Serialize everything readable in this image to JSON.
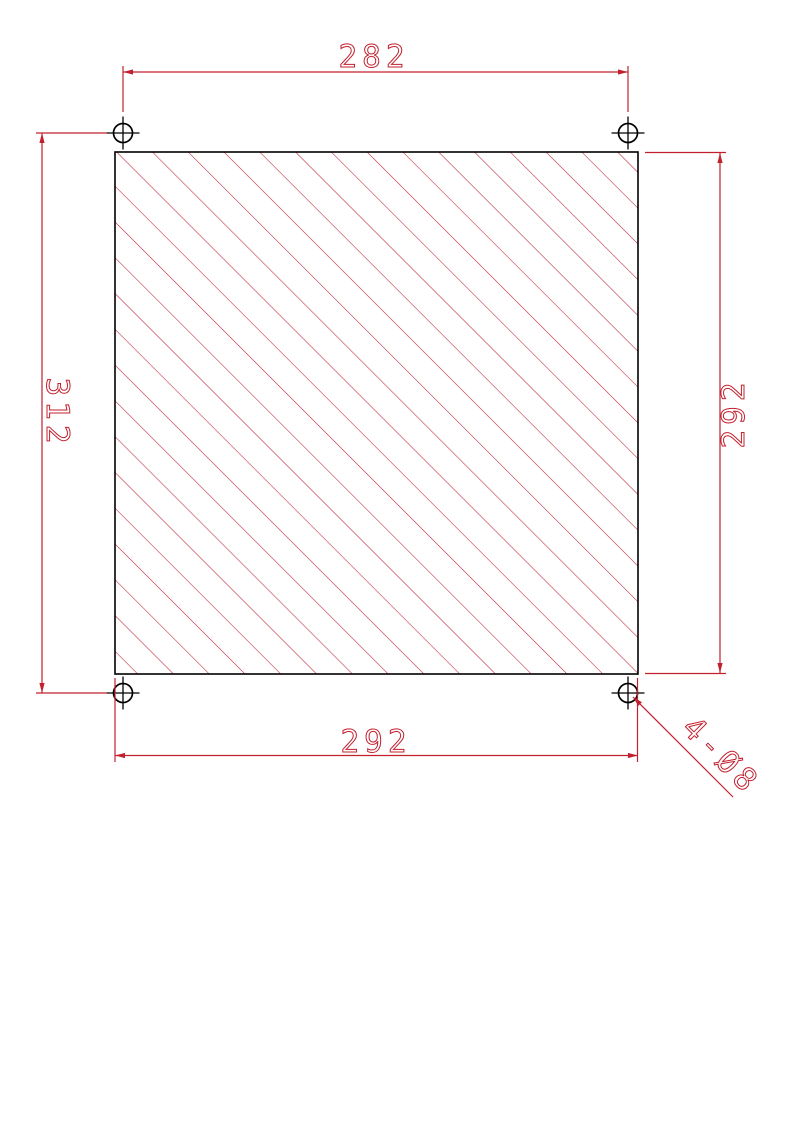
{
  "drawing": {
    "colors": {
      "dimension_red": "#c2202e",
      "hatch_red": "#bd2134",
      "outline_black": "#000000",
      "background": "#ffffff"
    },
    "dimensions": {
      "top_hole_pitch": "282",
      "left_hole_pitch": "312",
      "right_plate_height": "292",
      "bottom_plate_width": "292",
      "hole_callout": "4-Ø8"
    }
  }
}
